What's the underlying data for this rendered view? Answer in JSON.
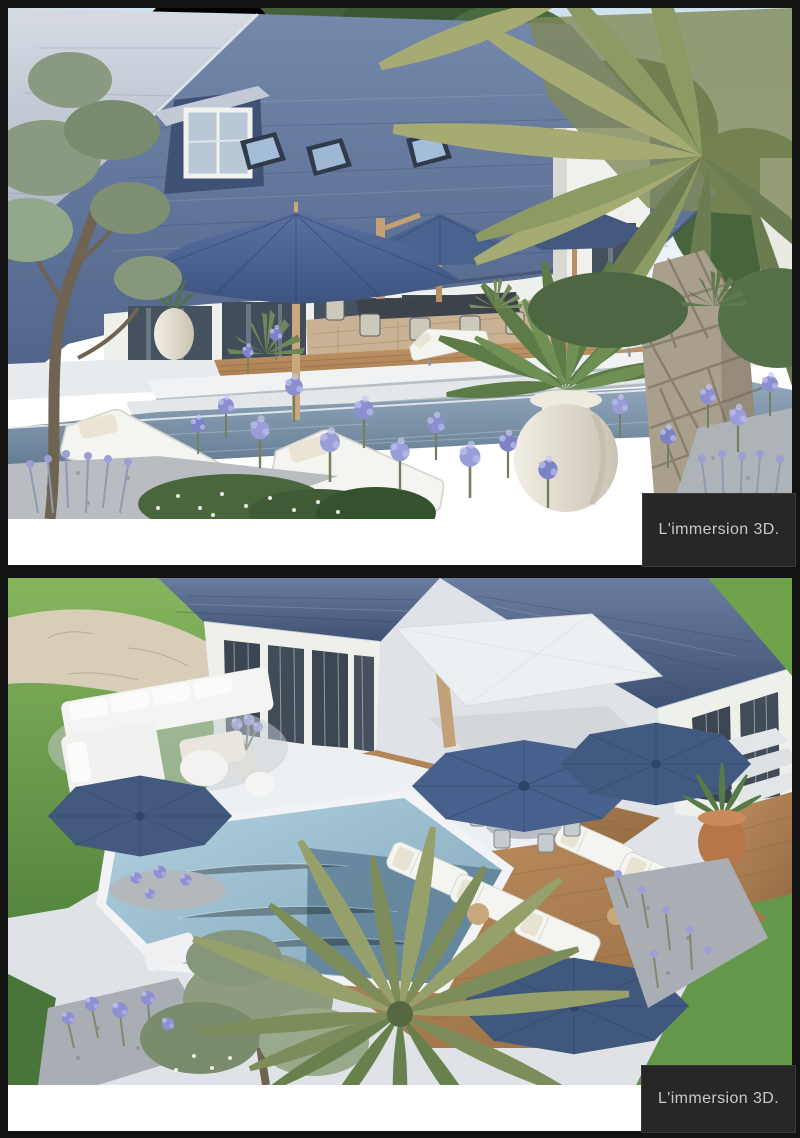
{
  "gallery": {
    "items": [
      {
        "caption": "L'immersion 3D.",
        "description": "exterior 3D render, garden level view of house with pool, palm tree and patio umbrellas"
      },
      {
        "caption": "L'immersion 3D.",
        "description": "exterior 3D render, aerial view of house courtyard with deck, loungers, umbrellas and pool"
      }
    ]
  },
  "palette": {
    "caption_bg": "#272727",
    "caption_border": "#3a3a3a",
    "caption_fg": "#c9cac3",
    "frame_black": "#131313",
    "white_bar": "#ffffff",
    "slate_roof": "#556a90",
    "umbrella_blue": "#47608c",
    "parasol_white": "#edf0f3",
    "pool_water": "#7e99b0",
    "deck_wood": "#b08155",
    "lawn_green": "#6fa24c",
    "flower_purple": "#8d91d2"
  }
}
